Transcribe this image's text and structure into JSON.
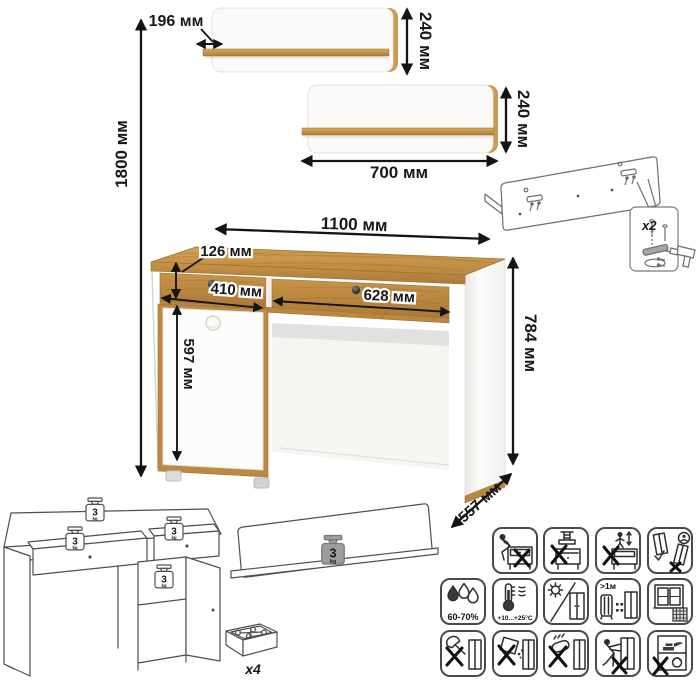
{
  "dims": {
    "shelf_small_depth": "196 мм",
    "shelf_small_height": "240 мм",
    "shelf_large_width": "700 мм",
    "shelf_large_height": "240 мм",
    "overall_height": "1800 мм",
    "desk_width": "1100 мм",
    "drawer_front_height": "126 мм",
    "left_drawer_width": "410 мм",
    "right_drawer_width": "628 мм",
    "door_height": "597 мм",
    "desk_height": "784 мм",
    "desk_depth": "557 мм"
  },
  "load": {
    "value": "3",
    "unit": "kg"
  },
  "counts": {
    "brackets": "x2",
    "feet": "x4"
  },
  "care": {
    "humidity": "60-70%",
    "temperature": "+10...+25°C",
    "heat_distance": ">1м"
  },
  "colors": {
    "wood": "#c08a45",
    "wood_dark": "#a5743a",
    "line": "#141414",
    "weight_gray": "#9d9d9d"
  },
  "icons": [
    "do-not-sit",
    "do-not-press",
    "do-not-climb",
    "carry-upright",
    "humidity",
    "temperature-range",
    "avoid-direct-sunlight",
    "keep-1m-from-heat",
    "ventilate-room",
    "no-sharp-tools",
    "no-liquids",
    "no-abrasives",
    "do-not-drag",
    "do-not-overload"
  ]
}
